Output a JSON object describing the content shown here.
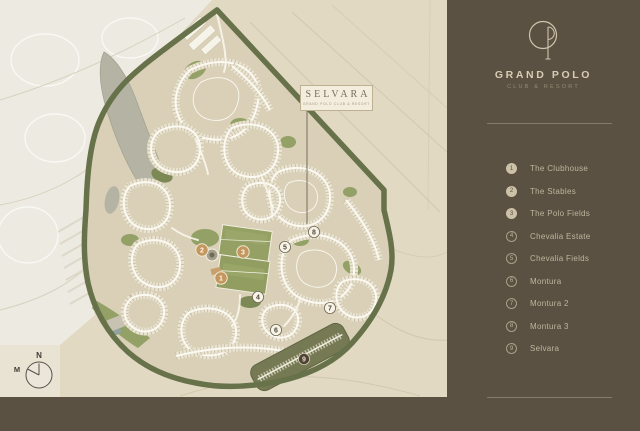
{
  "sidebar": {
    "logo_name": "grand-polo-monogram",
    "brand_title": "GRAND POLO",
    "brand_subtitle": "CLUB & RESORT",
    "legend": {
      "items": [
        {
          "num": "1",
          "label": "The Clubhouse",
          "style": "filled"
        },
        {
          "num": "2",
          "label": "The Stables",
          "style": "filled"
        },
        {
          "num": "3",
          "label": "The Polo Fields",
          "style": "filled"
        },
        {
          "num": "4",
          "label": "Chevalia Estate",
          "style": "outline"
        },
        {
          "num": "5",
          "label": "Chevalia Fields",
          "style": "outline"
        },
        {
          "num": "6",
          "label": "Montura",
          "style": "outline"
        },
        {
          "num": "7",
          "label": "Montura 2",
          "style": "outline"
        },
        {
          "num": "8",
          "label": "Montura 3",
          "style": "outline"
        },
        {
          "num": "9",
          "label": "Selvara",
          "style": "outline"
        }
      ]
    }
  },
  "map": {
    "label_box": {
      "title": "SELVARA",
      "subtitle": "GRAND POLO CLUB & RESORT"
    },
    "markers": [
      {
        "num": "1",
        "style": "tan"
      },
      {
        "num": "2",
        "style": "tan"
      },
      {
        "num": "3",
        "style": "tan"
      },
      {
        "num": "4",
        "style": "white"
      },
      {
        "num": "5",
        "style": "white"
      },
      {
        "num": "6",
        "style": "white"
      },
      {
        "num": "7",
        "style": "white"
      },
      {
        "num": "8",
        "style": "white"
      },
      {
        "num": "9",
        "style": "dark"
      }
    ],
    "compass": {
      "north": "N",
      "magnetic": "M"
    }
  },
  "colors": {
    "sidebar_bg": "#5a5143",
    "brand_cream": "#d9ccb4",
    "legend_text": "#bfb49c",
    "desert": "#e2d9c3",
    "faded_city": "#edeae1",
    "site_ground": "#d9d0b7",
    "boundary_green": "#67724b",
    "polo_green": "#95a164",
    "lake_gray": "#b5b4a4",
    "marker_tan": "#c3975e",
    "marker_dark": "#4c4335"
  }
}
